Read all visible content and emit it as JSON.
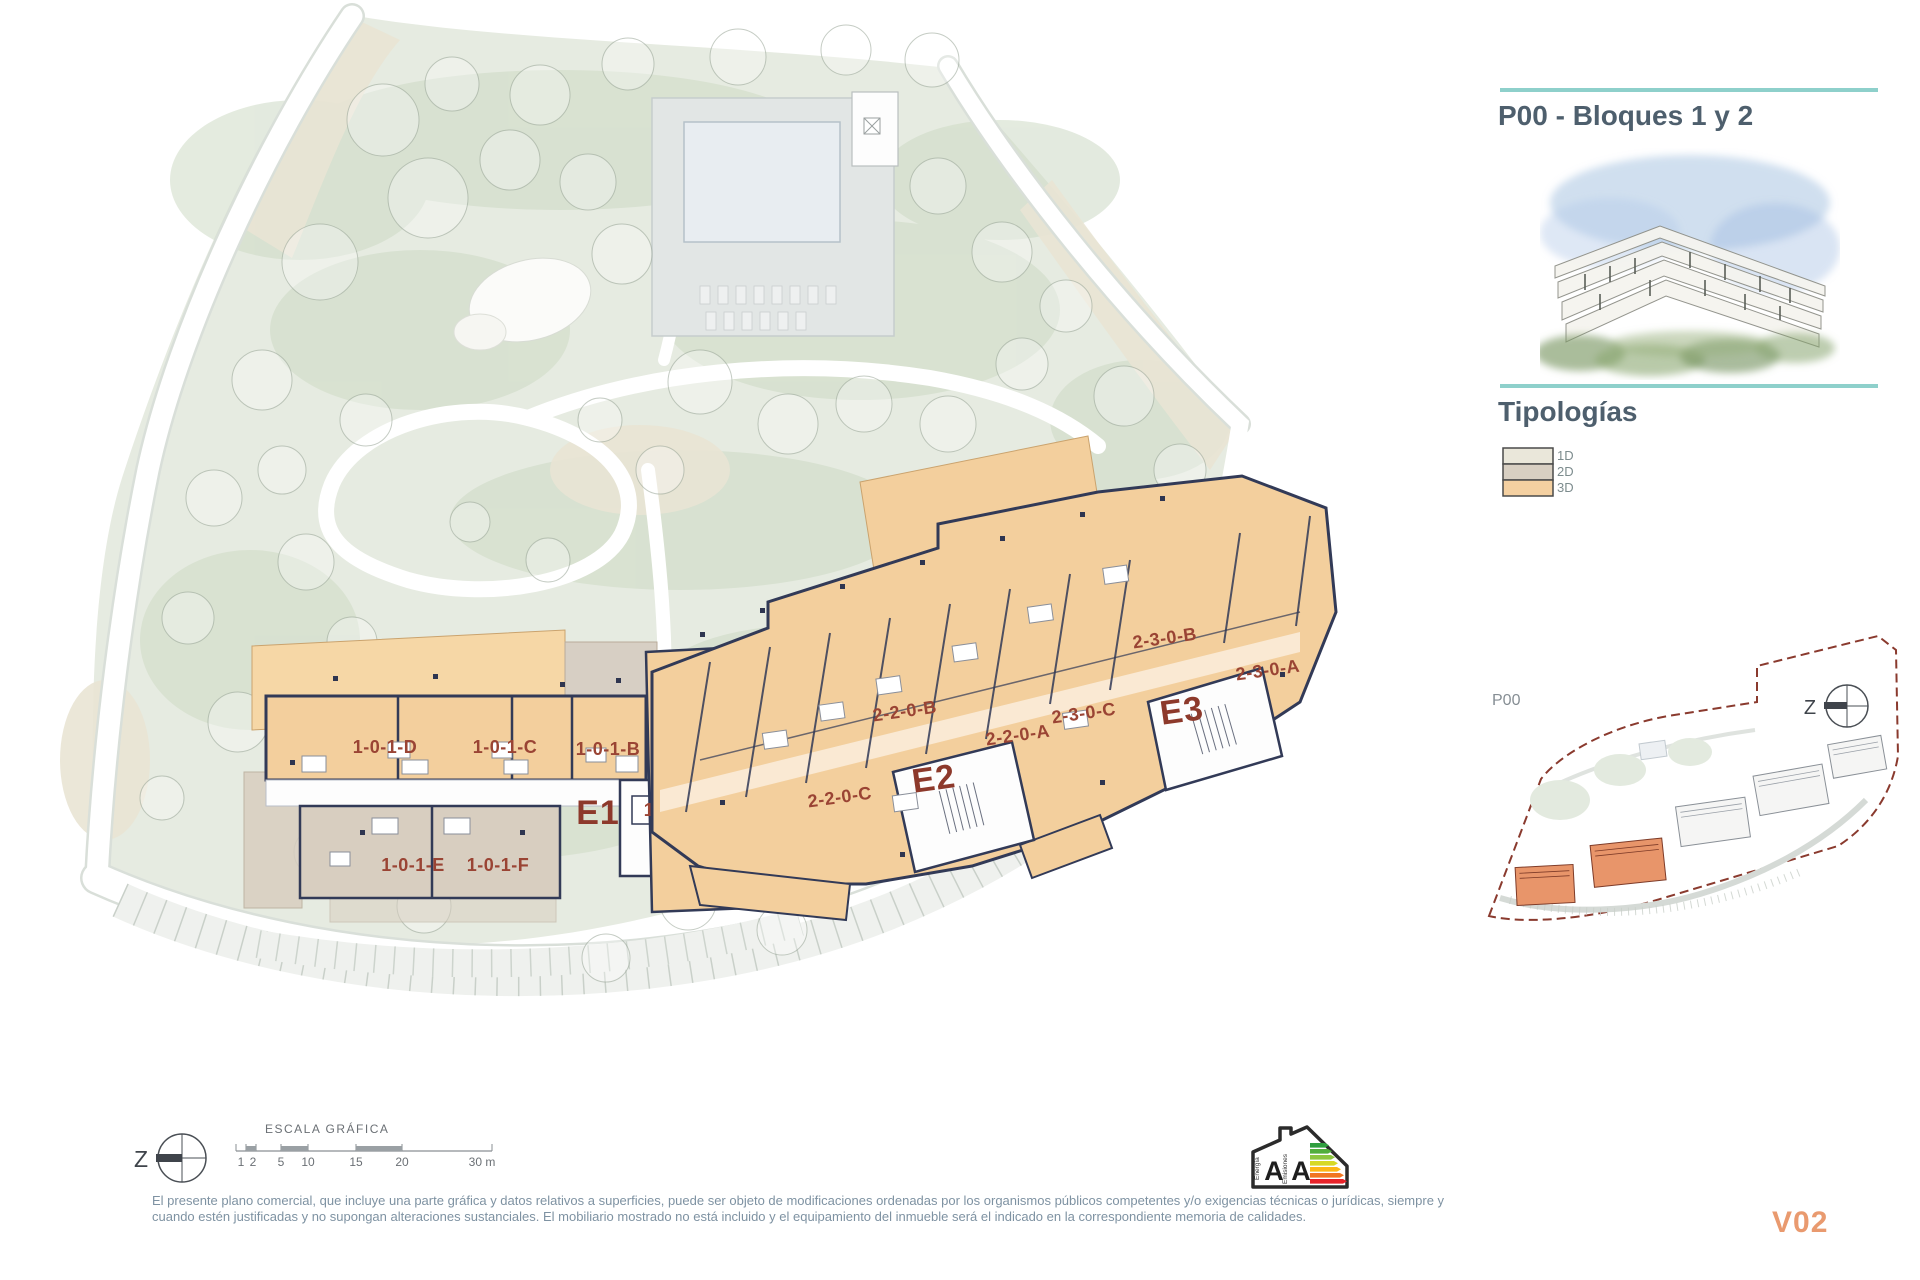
{
  "panel": {
    "title": "P00 - Bloques 1 y 2",
    "typologies_heading": "Tipologías",
    "legend": [
      {
        "label": "1D",
        "color": "#eae7da"
      },
      {
        "label": "2D",
        "color": "#d8cfc2"
      },
      {
        "label": "3D",
        "color": "#f4d0a1"
      }
    ],
    "minimap_label": "P00",
    "accent_teal": "#8ed0cb"
  },
  "plan": {
    "block1": {
      "core_label": "E1",
      "units": [
        "1-0-1-D",
        "1-0-1-C",
        "1-0-1-B",
        "1-0-1-A",
        "1-0-1-E",
        "1-0-1-F"
      ]
    },
    "block2": {
      "core_labels": [
        "E2",
        "E3"
      ],
      "units": [
        "2-2-0-C",
        "2-2-0-B",
        "2-2-0-A",
        "2-3-0-C",
        "2-3-0-B",
        "2-3-0-A"
      ]
    },
    "colors": {
      "typology_3d_fill": "#f3cf9d",
      "typology_2d_fill": "#d8cec0",
      "typology_1d_fill": "#eae7da",
      "wall": "#323a57",
      "unit_label": "#9a4434",
      "core_label": "#8d392b"
    }
  },
  "scalebar": {
    "title": "ESCALA GRÁFICA",
    "ticks": [
      "1",
      "2",
      "5",
      "10",
      "15",
      "20",
      "30 m"
    ]
  },
  "compass": {
    "letter": "Z"
  },
  "energy": {
    "letter_energy": "A",
    "letter_emissions": "A",
    "label_energy": "Energía",
    "label_emissions": "Emisiones"
  },
  "minimap": {
    "boundary_color": "#8a3a2e",
    "highlight_color": "#e8956a"
  },
  "footer": {
    "disclaimer_line1": "El presente plano comercial, que incluye una parte gráfica y datos relativos a superficies, puede ser objeto de modificaciones ordenadas por los organismos públicos competentes y/o exigencias técnicas o jurídicas, siempre y",
    "disclaimer_line2": "cuando estén justificadas y no supongan alteraciones sustanciales. El mobiliario mostrado no está incluido y el equipamiento del inmueble será el indicado en la correspondiente memoria de calidades.",
    "version": "V02"
  }
}
